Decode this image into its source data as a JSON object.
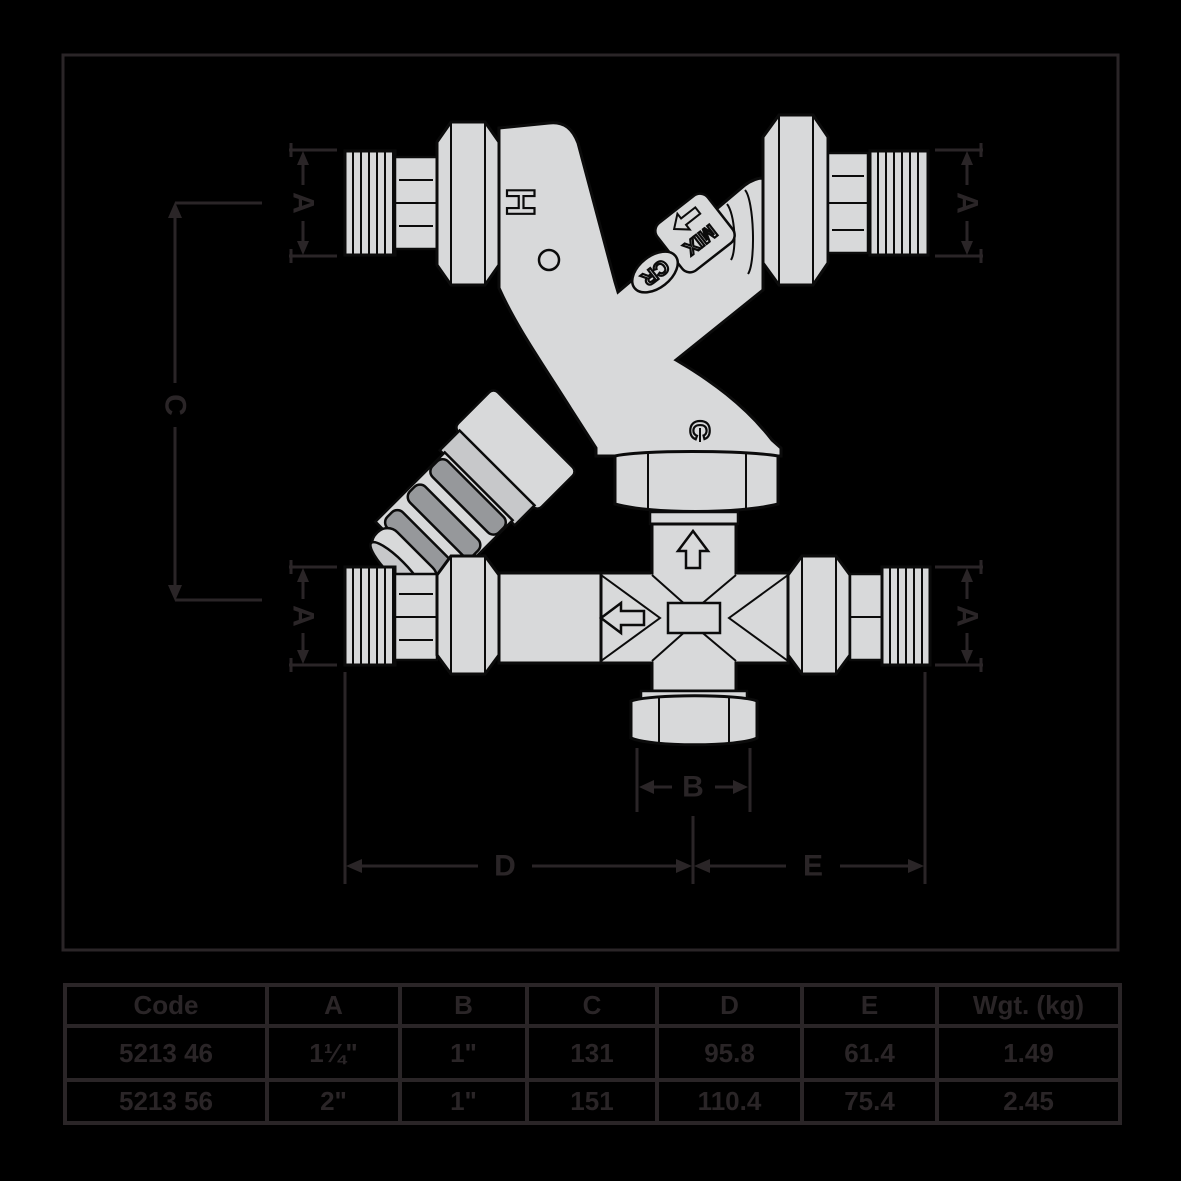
{
  "canvas": {
    "background": "#000000",
    "ink": "#2a2527",
    "valve_body_fill": "#d8d9da",
    "valve_outline": "#0b0b0b",
    "knob_rib_gray": "#96989b"
  },
  "diagram": {
    "markings": {
      "hot": "H",
      "mix": "MIX",
      "logo": "CR",
      "cold": "C"
    },
    "dims": {
      "a": "A",
      "b": "B",
      "c": "C",
      "d": "D",
      "e": "E"
    }
  },
  "table": {
    "headers": [
      "Code",
      "A",
      "B",
      "C",
      "D",
      "E",
      "Wgt. (kg)"
    ],
    "rows": [
      [
        "5213 46",
        "1¼\"",
        "1\"",
        "131",
        "95.8",
        "61.4",
        "1.49"
      ],
      [
        "5213 56",
        "2\"",
        "1\"",
        "151",
        "110.4",
        "75.4",
        "2.45"
      ]
    ]
  }
}
